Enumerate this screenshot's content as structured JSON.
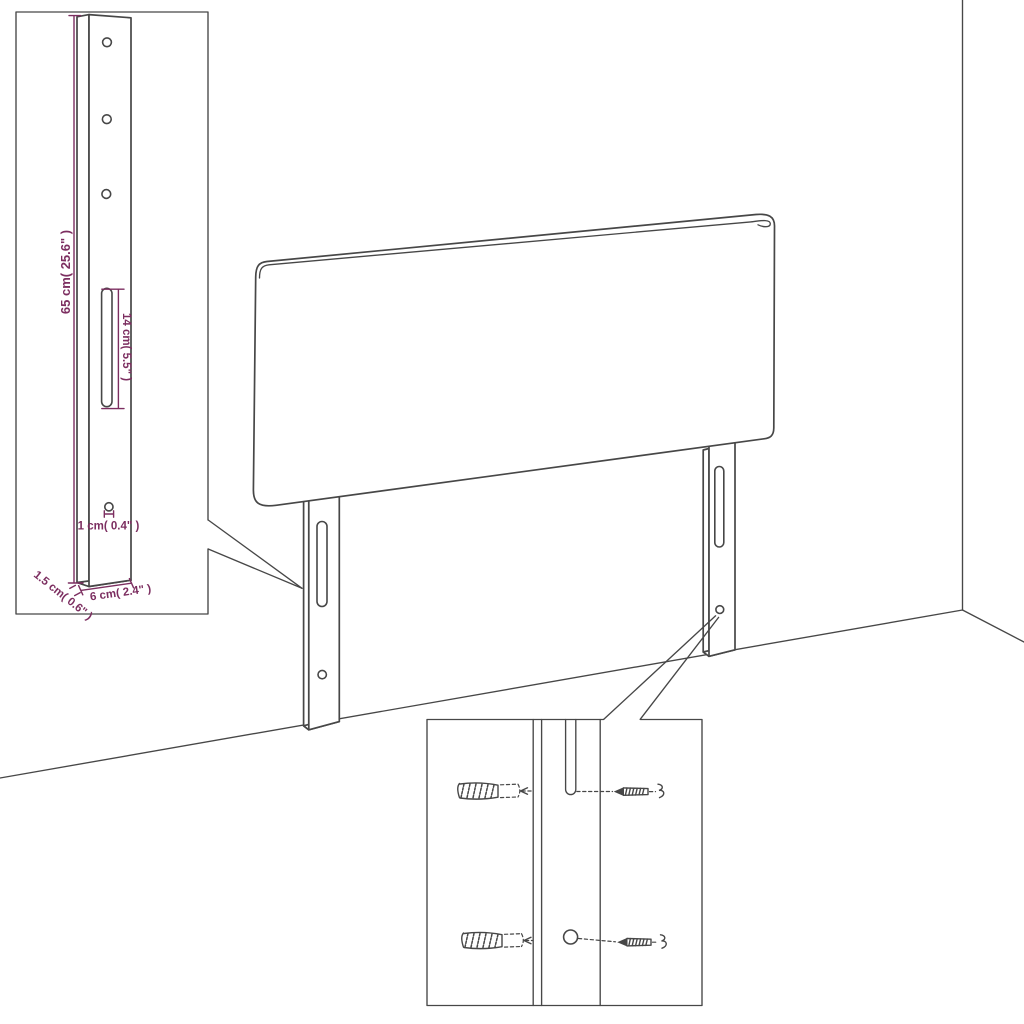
{
  "labels": {
    "leg_height": "65 cm( 25.6\" )",
    "slot_length": "14 cm( 5.5\" )",
    "hole_diameter": "1 cm( 0.4\" )",
    "leg_depth": "1.5 cm( 0.6\" )",
    "leg_width": "6 cm( 2.4\" )"
  },
  "colors": {
    "outline": "#474747",
    "dimension": "#7c2e60",
    "background": "#ffffff"
  }
}
